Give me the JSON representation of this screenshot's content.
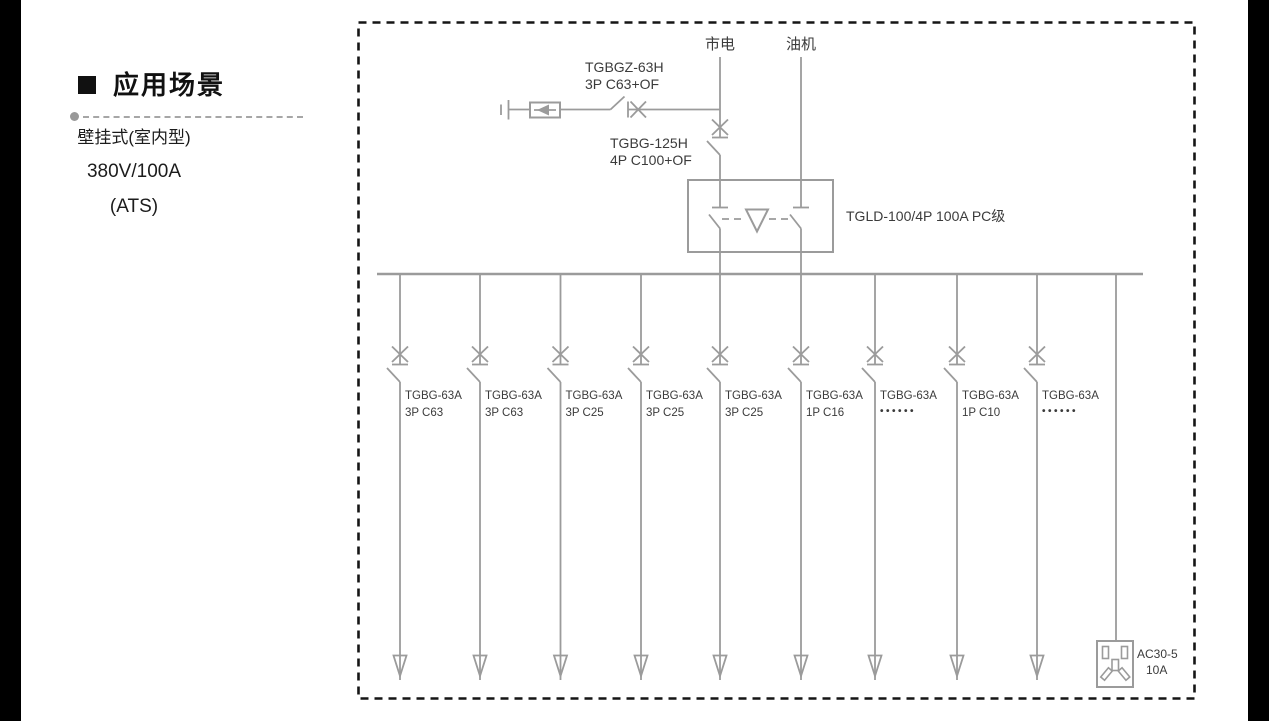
{
  "left_panel": {
    "heading": "应用场景",
    "line1": "壁挂式(室内型)",
    "line2": "380V/100A",
    "line3": "(ATS)"
  },
  "diagram": {
    "colors": {
      "line": "#9b9b9b",
      "text": "#3b3b3b",
      "border": "#151515"
    },
    "source_mains": "市电",
    "source_generator": "油机",
    "spd": {
      "model": "TGBGZ-63H",
      "spec": "3P C63+OF"
    },
    "main_breaker": {
      "model": "TGBG-125H",
      "spec": "4P C100+OF"
    },
    "ats": {
      "label": "TGLD-100/4P 100A PC级"
    },
    "branches": [
      {
        "model": "TGBG-63A",
        "spec": "3P C63"
      },
      {
        "model": "TGBG-63A",
        "spec": "3P C63"
      },
      {
        "model": "TGBG-63A",
        "spec": "3P C25"
      },
      {
        "model": "TGBG-63A",
        "spec": "3P C25"
      },
      {
        "model": "TGBG-63A",
        "spec": "3P C25"
      },
      {
        "model": "TGBG-63A",
        "spec": "1P C16"
      },
      {
        "model": "TGBG-63A",
        "spec": "••••••"
      },
      {
        "model": "TGBG-63A",
        "spec": "1P C10"
      },
      {
        "model": "TGBG-63A",
        "spec": "••••••"
      }
    ],
    "socket": {
      "model": "AC30-5",
      "rating": "10A"
    }
  }
}
